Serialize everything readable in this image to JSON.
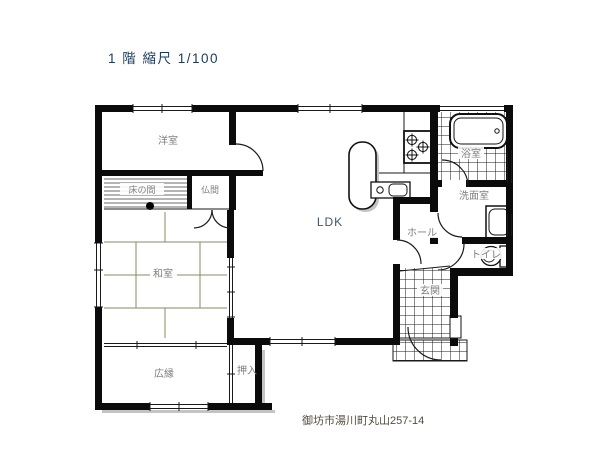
{
  "title": "1 階 縮尺 1/100",
  "address": "御坊市湯川町丸山257-14",
  "rooms": {
    "western_room": "洋室",
    "tokonoma": "床の間",
    "butsuma": "仏間",
    "japanese_room": "和室",
    "veranda": "広縁",
    "closet": "押入",
    "ldk": "LDK",
    "hall": "ホール",
    "entrance": "玄関",
    "bathroom": "浴室",
    "washroom": "洗面室",
    "toilet": "トイレ"
  },
  "colors": {
    "wall": "#0b0b0b",
    "label_gray": "#808080",
    "title_navy": "#1b3a5c",
    "ldk_navy": "#44546a",
    "tatami_olive": "#8a8a66",
    "address_brown": "#544d3f"
  },
  "scale_note": "1/100"
}
